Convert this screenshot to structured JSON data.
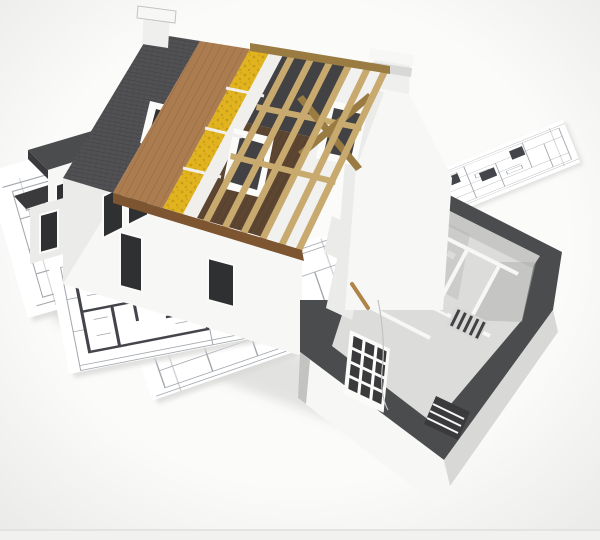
{
  "scene": {
    "subject": "cutaway-3d-house-model-on-blueprints",
    "parts": {
      "roof_layers": [
        "tiled-roof",
        "wood-sheathing",
        "insulation-layer",
        "membrane-strip",
        "open-rafters"
      ],
      "buildings": [
        "main-gable-house",
        "left-annex",
        "right-cutaway-wing"
      ],
      "ground": [
        "blueprint-sheets"
      ]
    }
  },
  "colors": {
    "background": "#fbfbfa",
    "vignette": "#e9e9e8",
    "bottom_strip": "#f1f1f0",
    "bottom_line": "#e3e3e2",
    "paper": "#ffffff",
    "paper_shadow": "#d9d9d7",
    "plan_line": "#a3a8ae",
    "plan_dark": "#43454a",
    "tile": "#515154",
    "tile_line": "#3e3e41",
    "wood": "#ab7c4f",
    "wood_dark": "#7d5531",
    "wood_line": "#8a5e35",
    "insulation": "#e0b31f",
    "insulation_dot": "#b1860e",
    "membrane": "#f1efec",
    "rafter": "#c8aa6f",
    "rafter_dark": "#9a7c42",
    "attic_dark": "#424244",
    "attic_floor": "#5c4631",
    "attic_floor_line": "#48331f",
    "inner_gable": "#f1f1f0",
    "wall_white": "#f7f7f6",
    "wall_light": "#ebebea",
    "wall_mid": "#d8d8d7",
    "wall_shadow": "#c3c3c2",
    "glass": "#2f3032",
    "frame": "#fbfbfa",
    "flat_roof": "#4b4c4e",
    "flat_roof_dark": "#3a3a3c",
    "floor_in": "#dcdcda",
    "wall_in": "#c7c7c6",
    "room_shadow": "#aeaeac",
    "chimney": "#efefed",
    "ground_shadow": "#cfcfcd",
    "stick": "#b08448"
  }
}
